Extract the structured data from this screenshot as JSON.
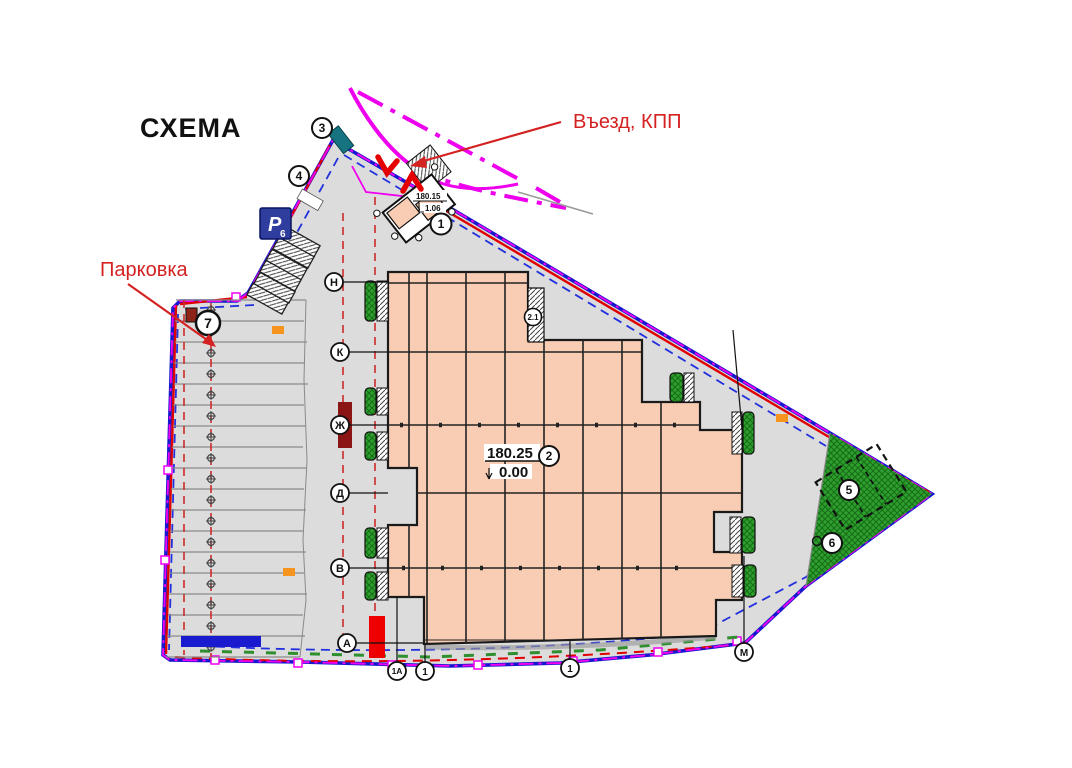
{
  "page": {
    "title": "СХЕМА"
  },
  "annotations": {
    "entrance": {
      "label": "Въезд, КПП"
    },
    "parking": {
      "label": "Парковка"
    }
  },
  "main_building": {
    "bubble": "2",
    "elevation_top": "180.25",
    "elevation_zero": "0.00",
    "annex_bubble": "2.1"
  },
  "kpp": {
    "bubble": "1",
    "elevation_top": "180.15",
    "elevation_low": "1.06"
  },
  "zone_bubbles": {
    "entrance_corner": "3",
    "upper_left": "4",
    "parking": "7",
    "sports": "5",
    "lawn": "6"
  },
  "grid": {
    "rows": [
      "Н",
      "К",
      "Ж",
      "Д",
      "В",
      "А"
    ],
    "cols": [
      "1А",
      "1",
      "1",
      "М"
    ]
  },
  "parking_sign": {
    "letter": "Р",
    "index": "6"
  },
  "colors": {
    "boundary_blue": "#1717ce",
    "boundary_red": "#e00000",
    "boundary_magenta": "#f000f0",
    "road_magenta": "#ee00ee",
    "building_fill": "#f8cdb4",
    "site_fill": "#dcdcdc",
    "green_zone": "#2fa02f",
    "annotation_red": "#d42222"
  }
}
